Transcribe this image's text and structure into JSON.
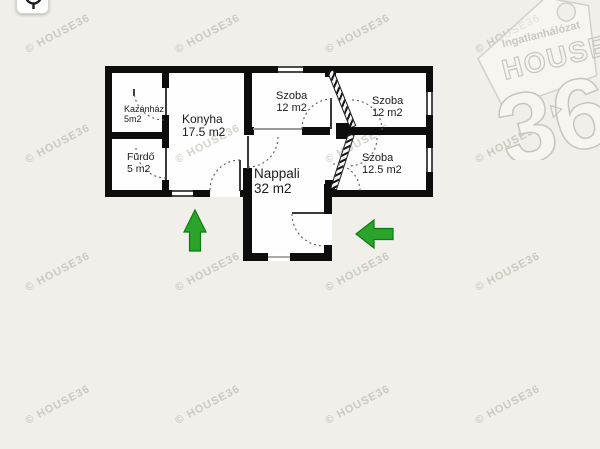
{
  "page": {
    "background_color": "#f1efe9",
    "floor_color": "#fefefe",
    "wall_color": "#0d0d0d"
  },
  "controls": {
    "top_left_button_icon": "magnifier-pin-icon"
  },
  "watermark": {
    "text": "© HOUSE36"
  },
  "logo": {
    "network": "Ingatlanhálózat",
    "brand": "HOUSE",
    "number": "36"
  },
  "arrows": {
    "color": "#2aa42a",
    "entrance_left": "up-arrow",
    "entrance_right": "left-arrow"
  },
  "floorplan": {
    "rooms": [
      {
        "id": "kazanhaz",
        "name": "Kazánház",
        "area": "5m2"
      },
      {
        "id": "furdo",
        "name": "Fürdő",
        "area": "5 m2"
      },
      {
        "id": "konyha",
        "name": "Konyha",
        "area": "17.5 m2"
      },
      {
        "id": "szoba-top-middle",
        "name": "Szoba",
        "area": "12 m2"
      },
      {
        "id": "szoba-top-right",
        "name": "Szoba",
        "area": "12 m2"
      },
      {
        "id": "szoba-right",
        "name": "Szoba",
        "area": "12.5 m2"
      },
      {
        "id": "nappali",
        "name": "Nappali",
        "area": "32 m2"
      }
    ]
  }
}
